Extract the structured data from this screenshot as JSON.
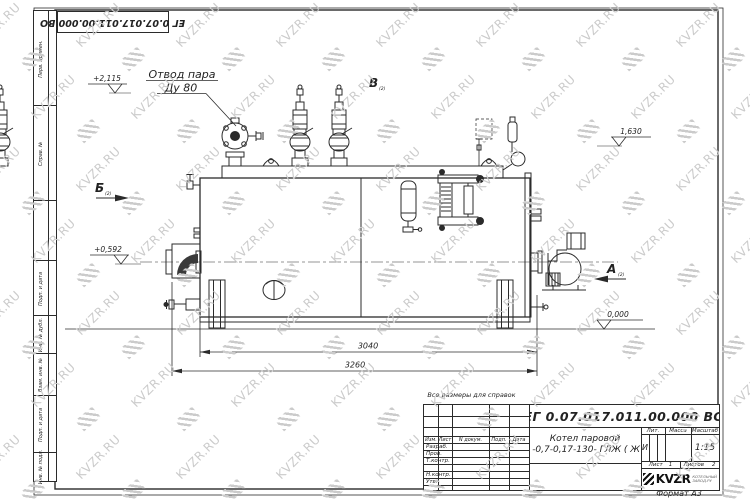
{
  "watermark": {
    "text": "KVZR.RU",
    "color": "#cbcbcb"
  },
  "stamp_top": "ЕГ 0.07.017.011.00.000  ВО",
  "margin_labels": [
    "Перв. примен.",
    "Справ. №",
    "Подп. и дата",
    "Инв. № дубл.",
    "Взам. инв. №",
    "Подп. и дата",
    "Инв. № подл."
  ],
  "drawing": {
    "labels": {
      "steam_outlet_line1": "Отвод пара",
      "steam_outlet_line2": "Ду 80",
      "level_top": "+2,115",
      "level_right": "1,630",
      "level_left": "+0,592",
      "level_zero": "0,000",
      "view_a": "А",
      "view_b": "Б",
      "view_v": "В",
      "view_sheet_ref": "(2)",
      "dim_inner": "3040",
      "dim_outer": "3260"
    }
  },
  "note": "Все размеры для справок",
  "title_block": {
    "doc_number": "ЕГ 0.07.017.011.00.000  ВО",
    "title_line1": "Котел паровой",
    "title_line2": "Е -0,7-0,17-130- ГЛЖ ( Ж )",
    "headers": {
      "izm": "Изм.",
      "list": "Лист",
      "n_dokum": "N докум.",
      "podp": "Подп.",
      "data": "Дата",
      "lit": "Лит.",
      "massa": "Масса",
      "masshtab": "Масштаб",
      "list_small": "Лист",
      "listov": "Листов"
    },
    "rows": [
      "Разраб.",
      "Пров.",
      "Т.контр.",
      "Н.контр.",
      "Утв."
    ],
    "lit_value": "И",
    "scale": "1:15",
    "sheet_no": "1",
    "sheets_total": "2",
    "logo_text": "KVZR",
    "logo_sub1": "КОТЕЛЬНЫЙ",
    "logo_sub2": "ЗАВОД.РУ",
    "format": "Формат А3"
  }
}
